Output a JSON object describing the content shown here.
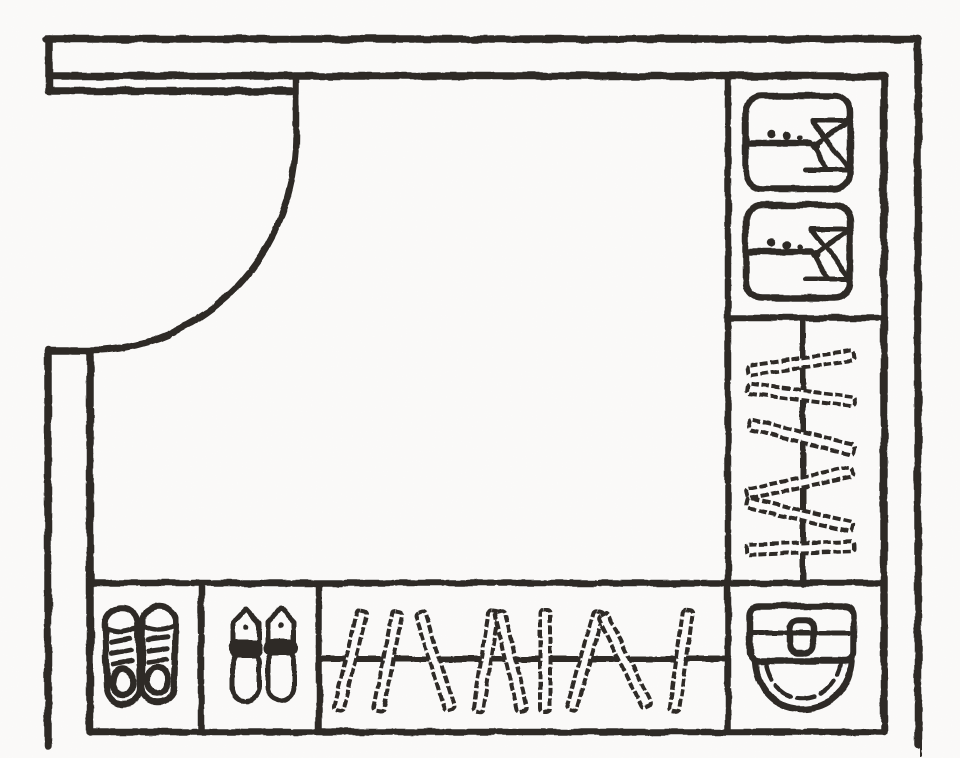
{
  "meta": {
    "description": "Hand-drawn monochrome floor plan sketch of an entryway cloakroom: entry door with swing arc at top-left, wardrobe column on the right with folded shirts and a vertical hanging rail, bottom cabinet row with sneakers, slippers, a horizontal hanging rail, and a toilet in the bottom-right corner",
    "style": "pencil sketch, scanned line drawing, no text labels"
  },
  "canvas": {
    "width": 960,
    "height": 758,
    "ink_color": "#2e2b28",
    "paper_color": "#fbfaf9"
  },
  "room": {
    "door": {
      "type": "single-swing-door",
      "position": "top-left",
      "swing": "quarter-arc"
    },
    "walls": {
      "style": "double-line",
      "texture": "dotted-sketch"
    },
    "compartments": [
      {
        "id": "top-right-shelf",
        "contents": "folded-shirts",
        "count": 2
      },
      {
        "id": "right-wardrobe",
        "contents": "clothes-on-hanging-rail",
        "rail_orientation": "vertical",
        "hanger_count": 6
      },
      {
        "id": "bottom-cabinet-1",
        "contents": "pair-of-sneakers",
        "count": 1
      },
      {
        "id": "bottom-cabinet-2",
        "contents": "pair-of-slippers",
        "count": 1
      },
      {
        "id": "bottom-wardrobe",
        "contents": "clothes-on-hanging-rail",
        "rail_orientation": "horizontal",
        "hanger_count": 9
      },
      {
        "id": "bottom-right-corner",
        "contents": "toilet",
        "count": 1
      }
    ]
  }
}
